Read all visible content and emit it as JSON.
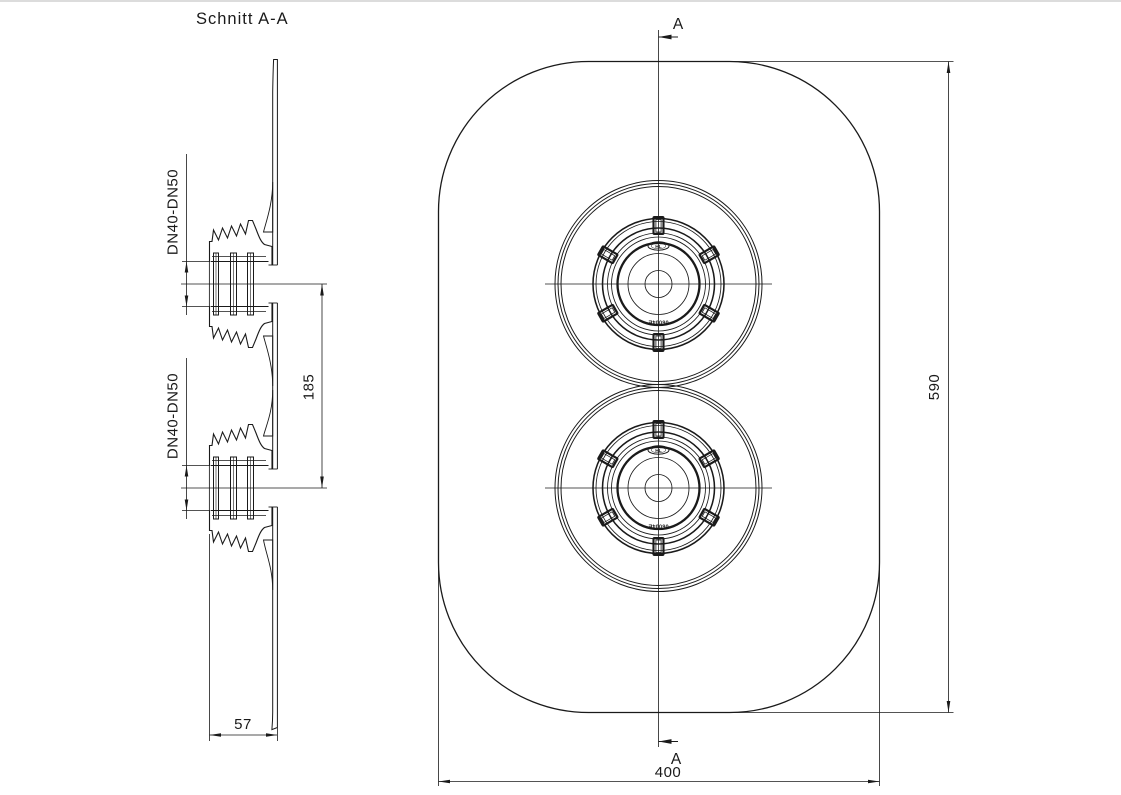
{
  "title": "Schnitt  A-A",
  "section_view": {
    "label_top_fitting": "DN40-DN50",
    "label_bottom_fitting": "DN40-DN50",
    "dim_center_spacing": "185",
    "dim_depth": "57"
  },
  "front_view": {
    "section_marker_top": "A",
    "section_marker_bottom": "A",
    "dim_height": "590",
    "dim_width": "400",
    "fitting_logo": "HL",
    "fitting_mold_text": "06004E"
  },
  "colors": {
    "line": "#1a1a1a",
    "background": "#ffffff",
    "top_border": "#dcdcdc"
  }
}
